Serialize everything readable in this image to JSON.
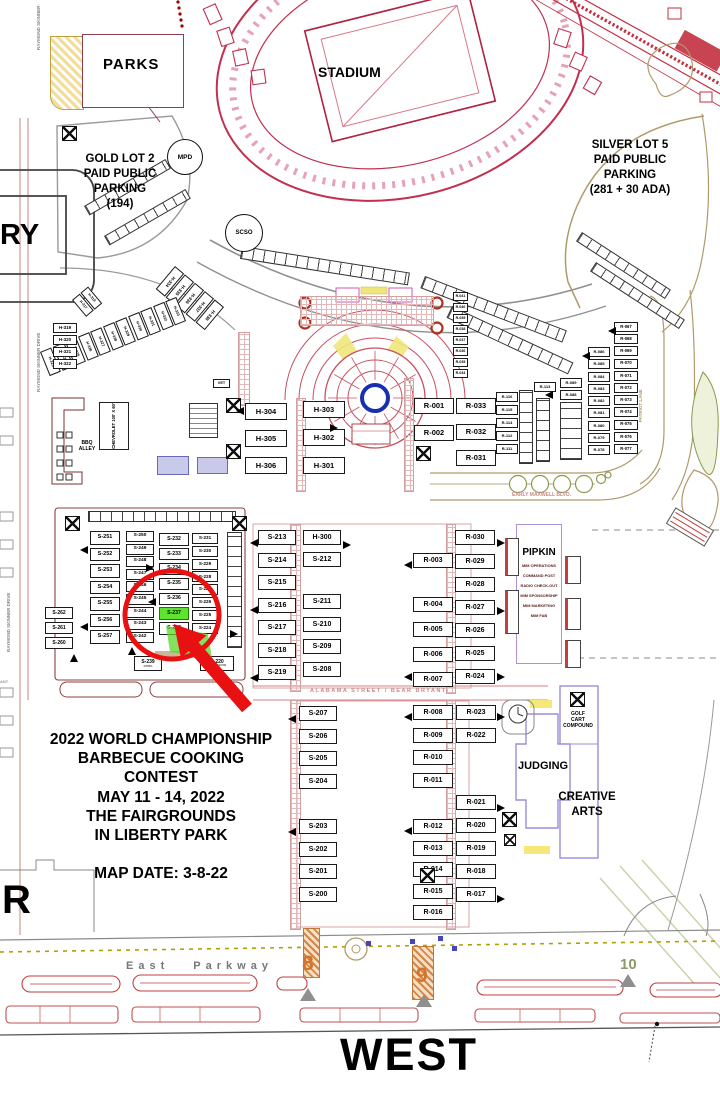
{
  "labels": {
    "parks": "PARKS",
    "stadium": "STADIUM",
    "mpd": "MPD",
    "scso": "SCSO",
    "armory_partial": "RY",
    "r_partial": "R",
    "west": "WEST",
    "vet": "VET",
    "ant_partial": "ANT",
    "gold_lot": [
      "GOLD LOT 2",
      "PAID PUBLIC",
      "PARKING",
      "(194)"
    ],
    "silver_lot": [
      "SILVER LOT 5",
      "PAID PUBLIC",
      "PARKING",
      "(281 + 30 ADA)"
    ],
    "chevrolet": "CHEVROLET 100' X 60'",
    "bbq_alley": [
      "BBQ",
      "ALLEY"
    ],
    "pipkin": "PIPKIN",
    "pipkin_lines": [
      "MIM OPERATIONS",
      "COMMAND POST",
      "RADIO CHECK-OUT",
      "MIM SPONSORSHIP",
      "MIM MARKETING",
      "MIM FAB"
    ],
    "judging": "JUDGING",
    "creative_arts": [
      "CREATIVE",
      "ARTS"
    ],
    "golf_cart": [
      "GOLF",
      "CART",
      "COMPOUND"
    ]
  },
  "streets": {
    "raymond_skinner": "RAYMOND SKINNER DRIVE",
    "early_maxwell": "EARLY MAXWELL BLVD.",
    "alabama": "ALABAMA STREET / BEAR BRYANT",
    "patriot": "PATRIOT LANE",
    "east_parkway": "East Parkway"
  },
  "gates": {
    "g8": "8",
    "g9": "9",
    "g10": "10"
  },
  "title_block": {
    "lines": [
      "2022 WORLD CHAMPIONSHIP",
      "BARBECUE COOKING",
      "CONTEST",
      "MAY 11 - 14, 2022",
      "THE FAIRGROUNDS",
      "IN LIBERTY PARK"
    ],
    "map_date": "MAP DATE:  3-8-22"
  },
  "annotation": {
    "highlighted_booth": "S-237",
    "circle_color": "#e81010",
    "highlight_color": "#5ee42e"
  },
  "booths": {
    "h_arc_upper": [
      "H-334",
      "H-335",
      "H-336",
      "H-337",
      "H-338"
    ],
    "h_arc_lower": [
      "H-323",
      "H-324",
      "H-325",
      "H-326",
      "H-327",
      "H-328",
      "H-329",
      "H-330",
      "H-331",
      "H-332",
      "H-333"
    ],
    "h_pair": [
      "H-317",
      "H-318"
    ],
    "h_col_west": [
      "H-319",
      "H-320",
      "H-321",
      "H-322"
    ],
    "h_col_304": [
      "H-304",
      "H-305",
      "H-306"
    ],
    "h_col_303": [
      "H-303",
      "H-302",
      "H-301"
    ],
    "r_col_ne_strip": [
      "R-041",
      "R-040",
      "R-039",
      "R-038",
      "R-037",
      "R-036",
      "R-035",
      "R-034"
    ],
    "r_col_001": [
      "R-001",
      "R-002"
    ],
    "r_col_033": [
      "R-033",
      "R-032",
      "R-031"
    ],
    "r_col_116": [
      "R-116",
      "R-115",
      "R-114",
      "R-112",
      "R-111"
    ],
    "r_col_113": [
      "R-113"
    ],
    "r_col_089": [
      "R-089",
      "R-088"
    ],
    "r_col_078": [
      "R-086",
      "R-085",
      "R-084",
      "R-083",
      "R-082",
      "R-081",
      "R-080",
      "R-079",
      "R-078"
    ],
    "r_col_067": [
      "R-067",
      "R-068",
      "R-069",
      "R-070",
      "R-071",
      "R-072",
      "R-073",
      "R-074",
      "R-075",
      "R-076",
      "R-077"
    ],
    "s_col_260": [
      "S-262",
      "S-261",
      "S-260"
    ],
    "s_col_251": [
      "S-251",
      "S-252",
      "S-253",
      "S-254",
      "S-255",
      "S-256",
      "S-257"
    ],
    "s_col_242": [
      "S-250",
      "S-249",
      "S-248",
      "S-247",
      "S-246",
      "S-245",
      "S-244",
      "S-243",
      "S-242"
    ],
    "s_col_232": [
      "S-232",
      "S-233",
      "S-234",
      "S-235",
      "S-236",
      {
        "label": "S-237",
        "highlight": true
      },
      "S-238"
    ],
    "s_col_224": [
      "S-231",
      "S-230",
      "S-229",
      "S-228",
      "S-227",
      "S-226",
      "S-225",
      "S-224"
    ],
    "s_wide_239": {
      "label": "S-239",
      "sub": "KPMG"
    },
    "s_wide_220": {
      "label": "S-220",
      "sub": "CONCESSIONS"
    },
    "s_col_213": [
      "S-213",
      "S-214",
      "S-215",
      "S-216",
      "S-217",
      "S-218",
      "S-219"
    ],
    "c_col_300a": [
      "H-300",
      "S-212"
    ],
    "c_col_300b": [
      "S-211",
      "S-210",
      "S-209",
      "S-208"
    ],
    "r_col_003a": [
      "R-003"
    ],
    "r_col_003b": [
      "R-004",
      "R-005",
      "R-006",
      "R-007"
    ],
    "r_col_030a": [
      "R-030"
    ],
    "r_col_030b": [
      "R-029",
      "R-028",
      "R-027",
      "R-026",
      "R-025",
      "R-024"
    ],
    "s_col_207": [
      "S-207",
      "S-206",
      "S-205",
      "S-204"
    ],
    "s_col_203": [
      "S-203",
      "S-202",
      "S-201",
      "S-200"
    ],
    "r_col_008": [
      "R-008",
      "R-009",
      "R-010",
      "R-011"
    ],
    "r_col_012": [
      "R-012",
      "R-013",
      "R-014",
      "R-015",
      "R-016"
    ],
    "r_col_023": [
      "R-023",
      "R-022"
    ],
    "r_col_021": [
      "R-021",
      "R-020",
      "R-019",
      "R-018",
      "R-017"
    ]
  }
}
